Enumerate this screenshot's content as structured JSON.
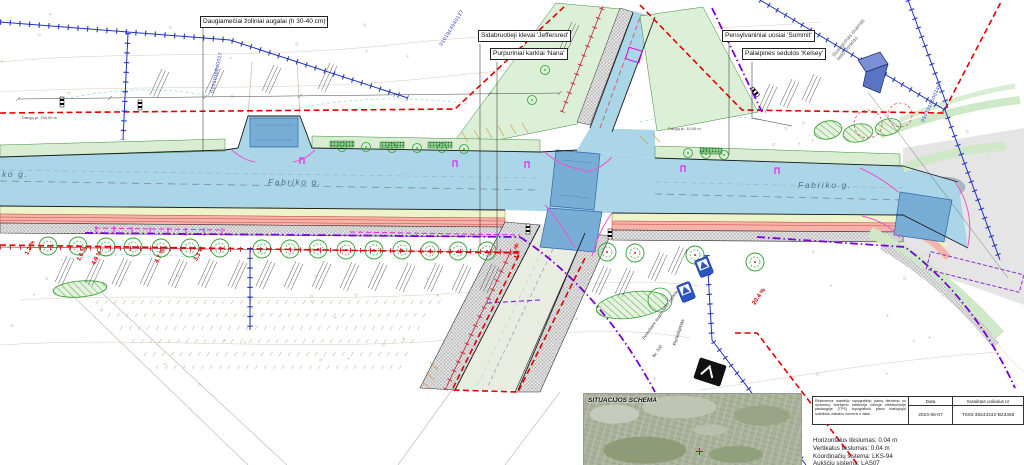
{
  "drawing": {
    "plant_labels": {
      "perennials": "Daugiamečiai žoliniai augalai (h 30-40 cm)",
      "maples": "Sidabruotieji klevai 'Jeffersred'",
      "willows": "Purpuriniai karklai 'Nana'",
      "ashes": "Pensylvaniniai uosiai 'Summit'",
      "dogwoods": "Palaipinės sedulos 'Kelsey'"
    },
    "street_labels": {
      "left_partial": "ko g.",
      "center": "Fabriko g.",
      "right": "Fabriko g."
    },
    "notes": {
      "preserved_sign": "Išsaugomas esamas\nkelio ženklas",
      "relocated_sign": "Perkeliamas",
      "relocated_signs_note": "Perkeliami esami kelio ženklai",
      "support_no": "Nr. 332"
    },
    "dimensions": {
      "left": "Dangų pl. 194.00 m",
      "right": "Dangų pl. 10.00 m"
    },
    "slopes": [
      "1.2 %",
      "1.6 %",
      "4.9 %",
      "4.7 %",
      "3.3 %",
      "4.6 %",
      "20.4 %"
    ],
    "parcel_numbers": [
      "0101016640027",
      "0101014640127",
      "0101016600348",
      "0101016640163"
    ],
    "colors": {
      "road_blue": "#aad6e8",
      "crossing_blue": "#78aed6",
      "boundary_red": "#e10000",
      "parcel_blue": "#2233bb",
      "boundary_purple": "#7a00d4",
      "vegetation_green": "#2f9e2f",
      "bike_path_salmon": "#f5b3a9",
      "utility_magenta": "#ee00ee"
    }
  },
  "schema": {
    "title": "SITUACIJOS SCHEMA"
  },
  "title_block": {
    "note": "Rinkmenos mastelio topografinių planų derinimo su duomenų tvarkymo institucija vienoje elektroninėje paslaugoje (TPS) topografinio plano tvarkytojui suteiktas unikalus numeris ir data.",
    "col_date": "Data",
    "col_number": "Suteiktas unikalus nr",
    "date": "2024-06-07",
    "number": "TS03-38243432-B23456"
  },
  "accuracy": {
    "line1": "Horizontalus tikslumas: 0.04 m",
    "line2": "Vertikalus tikslumas: 0.04 m",
    "line3": "Koordinačių sistema: LKS-94",
    "line4": "Aukščių sistema: LAS07"
  }
}
